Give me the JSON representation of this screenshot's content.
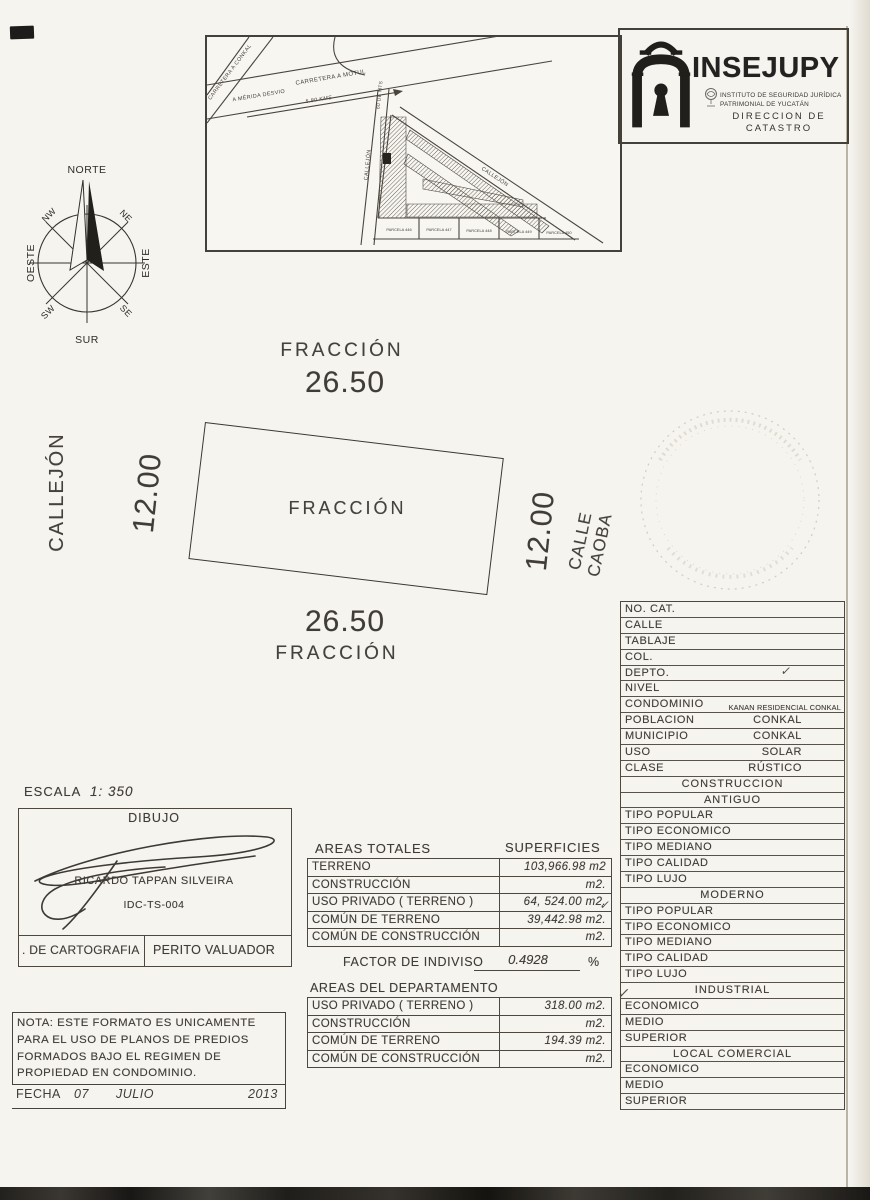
{
  "palette": {
    "paper": "#f6f4ef",
    "ink": "#403c36",
    "line": "#55504a"
  },
  "logo": {
    "name": "INSEJUPY",
    "line1": "INSTITUTO DE SEGURIDAD JURÍDICA",
    "line2": "PATRIMONIAL DE YUCATÁN",
    "dir1": "DIRECCION DE",
    "dir2": "CATASTRO"
  },
  "map_inset": {
    "labels": {
      "carretera_conkal": "CARRETERA A CONKAL",
      "a_merida": "A MÉRIDA DESVIO",
      "carretera_motul": "CARRETERA A MOTUL",
      "distance": "5.80 KMS",
      "road_width": "60 DE MTS",
      "callejon_left": "CALLEJÓN",
      "callejon_diag": "CALLEJÓN",
      "parcelas": [
        "PARCELA 446",
        "PARCELA 447",
        "PARCELA 448",
        "PARCELA 449",
        "PARCELA 450"
      ]
    }
  },
  "compass": {
    "north": "NORTE",
    "south": "SUR",
    "east": "ESTE",
    "west": "OESTE",
    "northwest": "NW",
    "northeast": "NE",
    "southwest": "SW",
    "southeast": "SE"
  },
  "plot": {
    "top_label": "FRACCIÓN",
    "top_dim": "26.50",
    "center_label": "FRACCIÓN",
    "bottom_dim": "26.50",
    "bottom_label": "FRACCIÓN",
    "left_dim": "12.00",
    "left_street": "CALLEJÓN",
    "right_dim": "12.00",
    "right_street": "CALLE CAOBA"
  },
  "cat_table": {
    "rows": [
      {
        "type": "row",
        "label": "NO.  CAT.",
        "value": ""
      },
      {
        "type": "row",
        "label": "CALLE",
        "value": ""
      },
      {
        "type": "row",
        "label": "TABLAJE",
        "value": ""
      },
      {
        "type": "row",
        "label": "COL.",
        "value": ""
      },
      {
        "type": "row",
        "label": "DEPTO.",
        "value": "",
        "check": true
      },
      {
        "type": "row",
        "label": "NIVEL",
        "value": ""
      },
      {
        "type": "row",
        "label": "CONDOMINIO",
        "value": "KANAN RESIDENCIAL CONKAL",
        "small": true
      },
      {
        "type": "row",
        "label": "POBLACION",
        "value": "CONKAL"
      },
      {
        "type": "row",
        "label": "MUNICIPIO",
        "value": "CONKAL"
      },
      {
        "type": "row",
        "label": "USO",
        "value": "SOLAR"
      },
      {
        "type": "row",
        "label": "CLASE",
        "value": "RÚSTICO"
      },
      {
        "type": "header",
        "label": "CONSTRUCCION"
      },
      {
        "type": "header",
        "label": "ANTIGUO"
      },
      {
        "type": "row",
        "label": "TIPO  POPULAR",
        "value": ""
      },
      {
        "type": "row",
        "label": "TIPO  ECONOMICO",
        "value": ""
      },
      {
        "type": "row",
        "label": "TIPO  MEDIANO",
        "value": ""
      },
      {
        "type": "row",
        "label": "TIPO  CALIDAD",
        "value": ""
      },
      {
        "type": "row",
        "label": "TIPO  LUJO",
        "value": ""
      },
      {
        "type": "header",
        "label": "MODERNO"
      },
      {
        "type": "row",
        "label": "TIPO  POPULAR",
        "value": ""
      },
      {
        "type": "row",
        "label": "TIPO  ECONOMICO",
        "value": ""
      },
      {
        "type": "row",
        "label": "TIPO  MEDIANO",
        "value": ""
      },
      {
        "type": "row",
        "label": "TIPO  CALIDAD",
        "value": ""
      },
      {
        "type": "row",
        "label": "TIPO  LUJO",
        "value": ""
      },
      {
        "type": "header",
        "label": "INDUSTRIAL"
      },
      {
        "type": "row",
        "label": "ECONOMICO",
        "value": ""
      },
      {
        "type": "row",
        "label": "MEDIO",
        "value": ""
      },
      {
        "type": "row",
        "label": "SUPERIOR",
        "value": ""
      },
      {
        "type": "header",
        "label": "LOCAL  COMERCIAL"
      },
      {
        "type": "row",
        "label": "ECONOMICO",
        "value": ""
      },
      {
        "type": "row",
        "label": "MEDIO",
        "value": ""
      },
      {
        "type": "row",
        "label": "SUPERIOR",
        "value": ""
      }
    ]
  },
  "escala": {
    "label": "ESCALA",
    "value": "1: 350"
  },
  "dibujo": {
    "title": "DIBUJO",
    "name": "RICARDO TAPPAN SILVEIRA",
    "id": "IDC-TS-004"
  },
  "cargo": {
    "left": ". DE CARTOGRAFIA",
    "right": "PERITO VALUADOR"
  },
  "areas_totales": {
    "title": "AREAS TOTALES",
    "superficies_label": "SUPERFICIES",
    "rows": [
      {
        "label": "TERRENO",
        "value": "103,966.98 m2"
      },
      {
        "label": "CONSTRUCCIÓN",
        "value": "m2."
      },
      {
        "label": "USO PRIVADO  ( TERRENO )",
        "value": "64, 524.00 m2."
      },
      {
        "label": "COMÚN DE TERRENO",
        "value": "39,442.98 m2."
      },
      {
        "label": "COMÚN DE CONSTRUCCIÓN",
        "value": "m2."
      }
    ]
  },
  "factor": {
    "label": "FACTOR DE INDIVISO",
    "value": "0.4928",
    "unit": "%"
  },
  "areas_depto": {
    "title": "AREAS DEL DEPARTAMENTO",
    "rows": [
      {
        "label": "USO PRIVADO  ( TERRENO )",
        "value": "318.00 m2."
      },
      {
        "label": "CONSTRUCCIÓN",
        "value": "m2."
      },
      {
        "label": "COMÚN DE TERRENO",
        "value": "194.39 m2."
      },
      {
        "label": "COMÚN DE CONSTRUCCIÓN",
        "value": "m2."
      }
    ]
  },
  "nota": {
    "lines": [
      "NOTA: ESTE FORMATO ES UNICAMENTE",
      "PARA  EL USO DE PLANOS DE  PREDIOS",
      "FORMADOS  BAJO  EL  REGIMEN  DE",
      "PROPIEDAD  EN  CONDOMINIO."
    ]
  },
  "fecha": {
    "label": "FECHA",
    "day": "07",
    "month": "JULIO",
    "year": "2013"
  }
}
